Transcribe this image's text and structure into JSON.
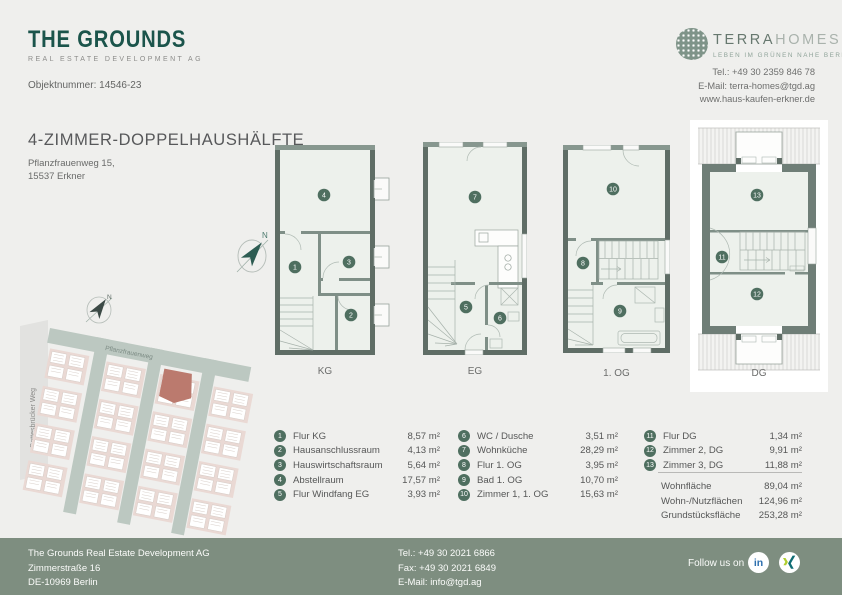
{
  "page": {
    "bg": "#efefed",
    "accent_teal": "#1b544b",
    "badge_green": "#4f6f60",
    "wall_color": "#5f6d66",
    "footer_green": "#7e8e80",
    "highlight_red": "#bb7a6e"
  },
  "header": {
    "logo": {
      "name": "THE GROUNDS",
      "tagline": "REAL ESTATE DEVELOPMENT AG"
    },
    "object_number": "Objektnummer: 14546-23",
    "partner": {
      "brand_primary": "TERRA",
      "brand_secondary": "HOMES",
      "claim": "LEBEN IM GRÜNEN NAHE BERLIN",
      "phone": "Tel.: +49 30 2359 846 78",
      "email": "E-Mail: terra-homes@tgd.ag",
      "website": "www.haus-kaufen-erkner.de"
    }
  },
  "listing": {
    "title": "4-ZIMMER-DOPPELHAUSHÄLFTE",
    "address_line1": "Pflanzfrauenweg 15,",
    "address_line2": "15537 Erkner"
  },
  "floors": [
    {
      "label": "KG"
    },
    {
      "label": "EG"
    },
    {
      "label": "1. OG"
    },
    {
      "label": "DG"
    }
  ],
  "compass": {
    "north": "N"
  },
  "site_map": {
    "street_left": "Gottesbrücker Weg",
    "street_top": "Pflanzfrauenweg"
  },
  "rooms": [
    {
      "num": "1",
      "label": "Flur KG",
      "area": "8,57 m²"
    },
    {
      "num": "2",
      "label": "Hausanschlussraum",
      "area": "4,13 m²"
    },
    {
      "num": "3",
      "label": "Hauswirtschaftsraum",
      "area": "5,64 m²"
    },
    {
      "num": "4",
      "label": "Abstellraum",
      "area": "17,57 m²"
    },
    {
      "num": "5",
      "label": "Flur Windfang EG",
      "area": "3,93 m²"
    },
    {
      "num": "6",
      "label": "WC / Dusche",
      "area": "3,51 m²"
    },
    {
      "num": "7",
      "label": "Wohnküche",
      "area": "28,29 m²"
    },
    {
      "num": "8",
      "label": "Flur 1. OG",
      "area": "3,95 m²"
    },
    {
      "num": "9",
      "label": "Bad 1. OG",
      "area": "10,70 m²"
    },
    {
      "num": "10",
      "label": "Zimmer 1, 1. OG",
      "area": "15,63 m²"
    },
    {
      "num": "11",
      "label": "Flur DG",
      "area": "1,34 m²"
    },
    {
      "num": "12",
      "label": "Zimmer 2, DG",
      "area": "9,91 m²"
    },
    {
      "num": "13",
      "label": "Zimmer 3, DG",
      "area": "11,88 m²"
    }
  ],
  "totals": [
    {
      "label": "Wohnfläche",
      "value": "89,04 m²"
    },
    {
      "label": "Wohn-/Nutzflächen",
      "value": "124,96 m²"
    },
    {
      "label": "Grundstücksfläche",
      "value": "253,28 m²"
    }
  ],
  "footer": {
    "company": "The Grounds Real Estate Development AG",
    "address_line1": "Zimmerstraße 16",
    "address_line2": "DE-10969 Berlin",
    "phone": "Tel.: +49 30 2021 6866",
    "fax": "Fax: +49 30 2021 6849",
    "email": "E-Mail: info@tgd.ag",
    "follow_label": "Follow us on",
    "social_linkedin": "in"
  }
}
